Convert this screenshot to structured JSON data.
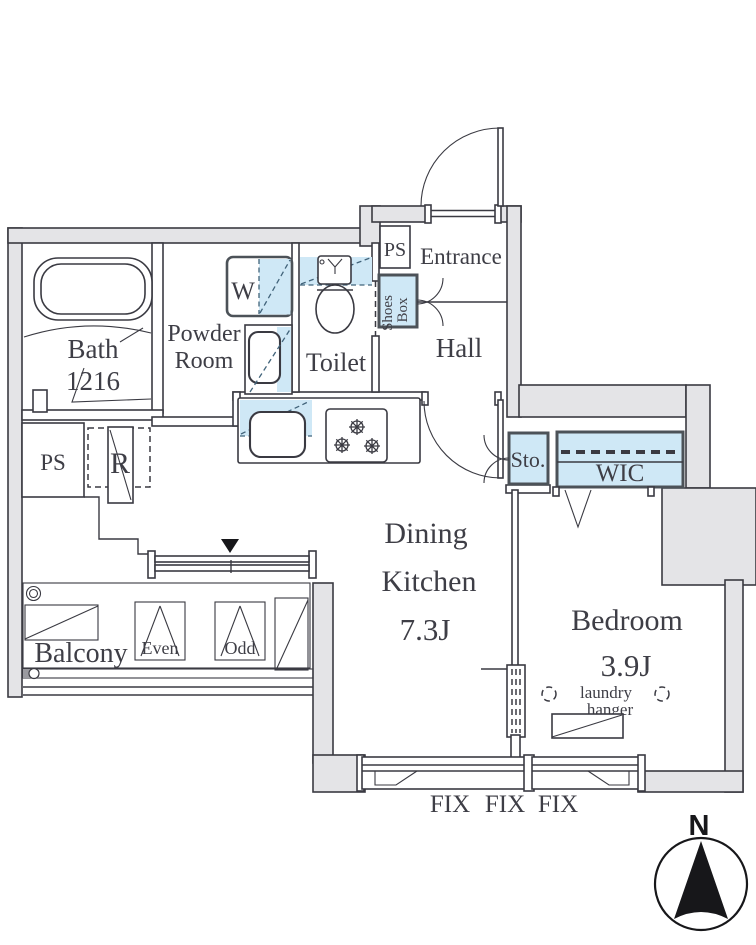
{
  "rooms": {
    "bath": {
      "name": "Bath",
      "size": "1216"
    },
    "powder_room": {
      "name_line1": "Powder",
      "name_line2": "Room"
    },
    "toilet": {
      "name": "Toilet"
    },
    "entrance": {
      "name": "Entrance"
    },
    "hall": {
      "name": "Hall"
    },
    "dining_kitchen": {
      "name_line1": "Dining",
      "name_line2": "Kitchen",
      "size": "7.3J"
    },
    "bedroom": {
      "name": "Bedroom",
      "size": "3.9J"
    },
    "balcony": {
      "name": "Balcony"
    },
    "wic": {
      "name": "WIC"
    },
    "storage": {
      "name": "Sto."
    }
  },
  "fixtures": {
    "washer": "W",
    "pipe_space_entrance": "PS",
    "pipe_space_utility": "PS",
    "refrigerator": "R",
    "shoes_box_line1": "Shoes",
    "shoes_box_line2": "Box",
    "laundry_hanger_line1": "laundry",
    "laundry_hanger_line2": "hanger",
    "balcony_panel_even": "Even",
    "balcony_panel_odd": "Odd"
  },
  "windows": {
    "fix_labels": [
      "FIX",
      "FIX",
      "FIX"
    ]
  },
  "compass": {
    "north": "N"
  },
  "colors": {
    "wall_fill": "#e4e4e7",
    "wall_line": "#3a3a42",
    "fixture_blue": "#cfe8f6",
    "fixture_border": "#4c5258",
    "label_text": "#3e3e46",
    "compass_needle": "#17171a"
  }
}
